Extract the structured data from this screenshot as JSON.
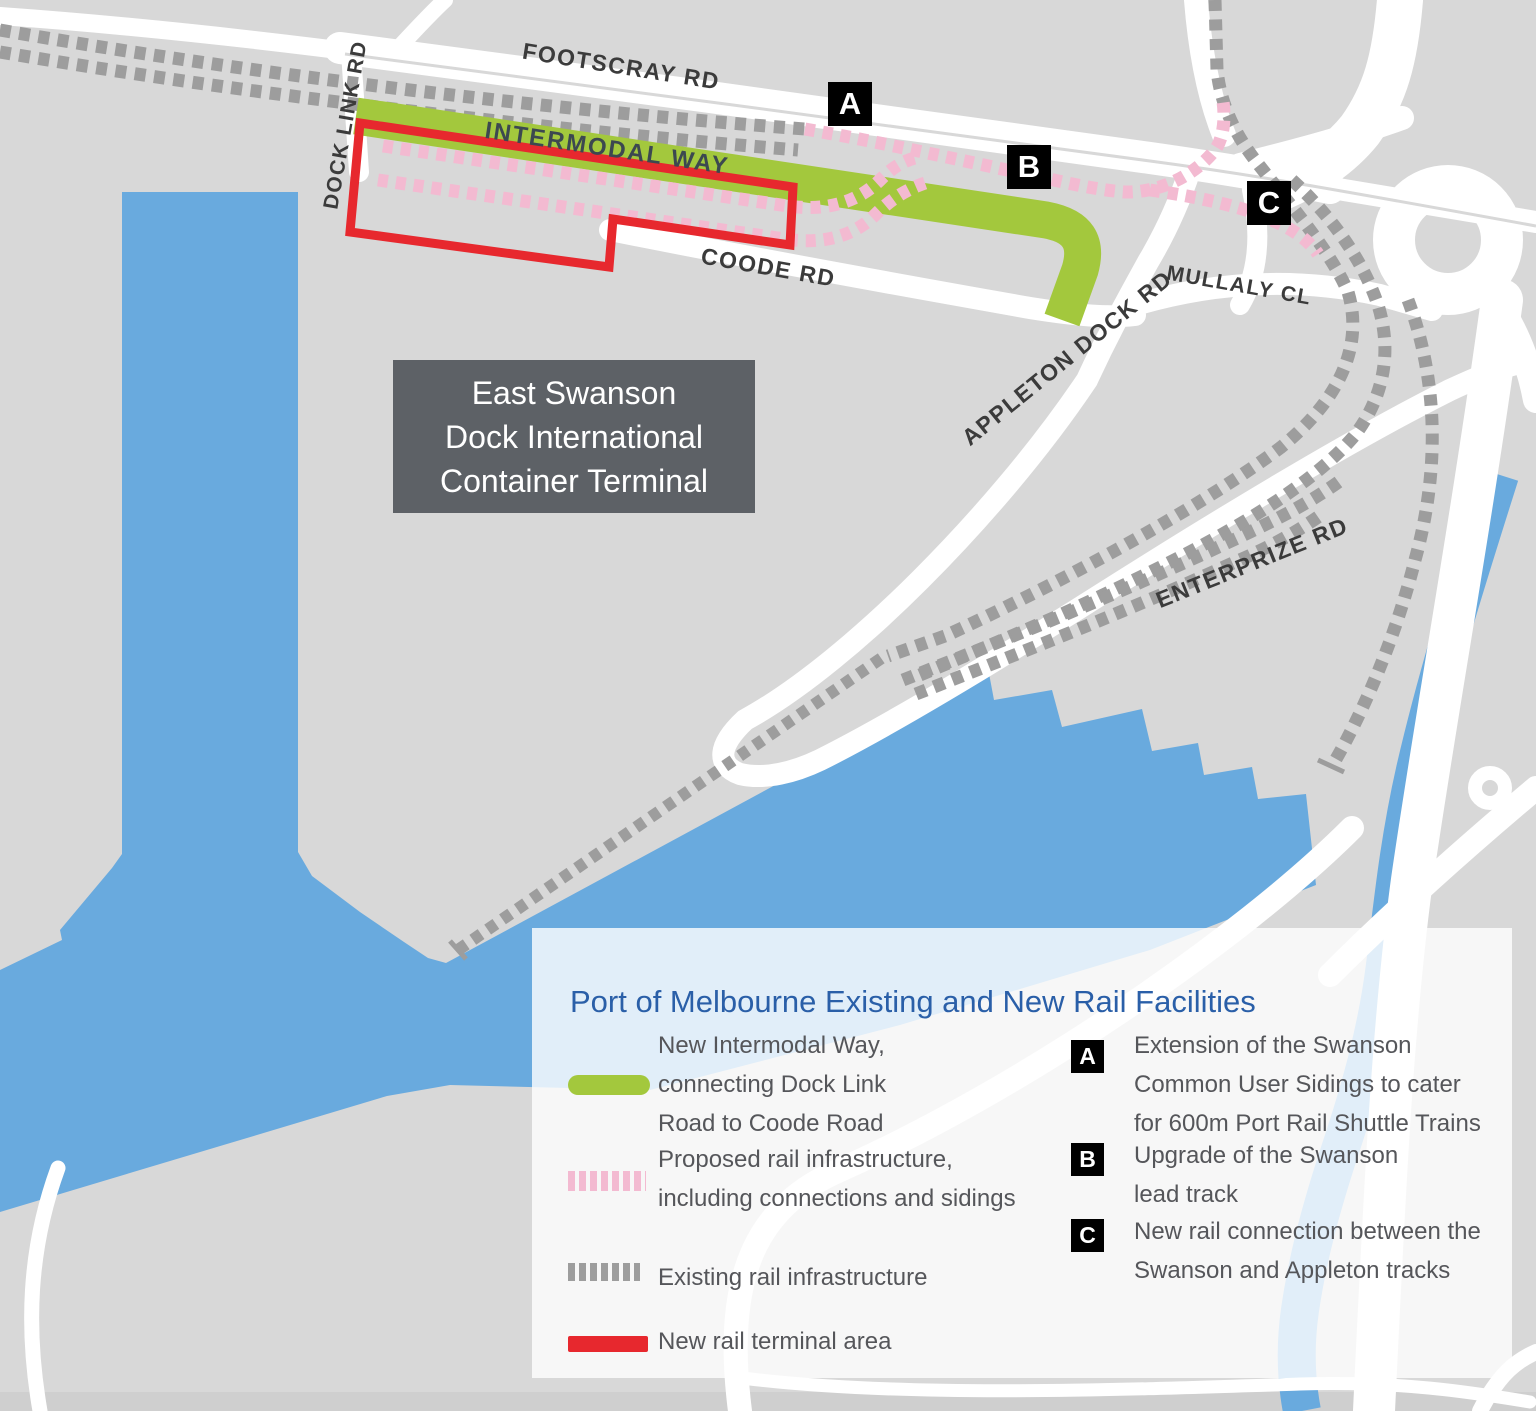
{
  "map": {
    "road_labels": {
      "footscray": "FOOTSCRAY RD",
      "dock_link": "DOCK LINK RD",
      "intermodal": "INTERMODAL WAY",
      "coode": "COODE RD",
      "appleton": "APPLETON DOCK RD",
      "mullaly": "MULLALY CL",
      "enterprize": "ENTERPRIZE RD"
    },
    "terminal_label": "East Swanson\nDock International\nContainer Terminal",
    "markers": [
      {
        "id": "A"
      },
      {
        "id": "B"
      },
      {
        "id": "C"
      }
    ],
    "colors": {
      "land": "#d8d8d8",
      "water": "#69aade",
      "road": "#ffffff",
      "existing_rail": "#9d9d9d",
      "proposed_rail": "#f3bad1",
      "intermodal_way": "#a3c83d",
      "terminal_area": "#e7282e",
      "terminal_box": "#5d6166",
      "title_blue": "#2a5fa8"
    }
  },
  "legend": {
    "title": "Port of Melbourne Existing and New Rail Facilities",
    "items": [
      {
        "swatch": "green-line",
        "label": "New Intermodal Way,\nconnecting Dock Link\nRoad to Coode Road"
      },
      {
        "swatch": "pink-dashes",
        "label": "Proposed rail infrastructure,\nincluding connections and sidings"
      },
      {
        "swatch": "gray-dashes",
        "label": "Existing rail infrastructure"
      },
      {
        "swatch": "red-line",
        "label": "New rail terminal area"
      }
    ],
    "callouts": [
      {
        "key": "A",
        "text": "Extension of the Swanson\nCommon User Sidings to cater\nfor 600m Port Rail Shuttle Trains"
      },
      {
        "key": "B",
        "text": "Upgrade of the Swanson\nlead track"
      },
      {
        "key": "C",
        "text": "New rail connection between the\nSwanson and Appleton tracks"
      }
    ]
  }
}
